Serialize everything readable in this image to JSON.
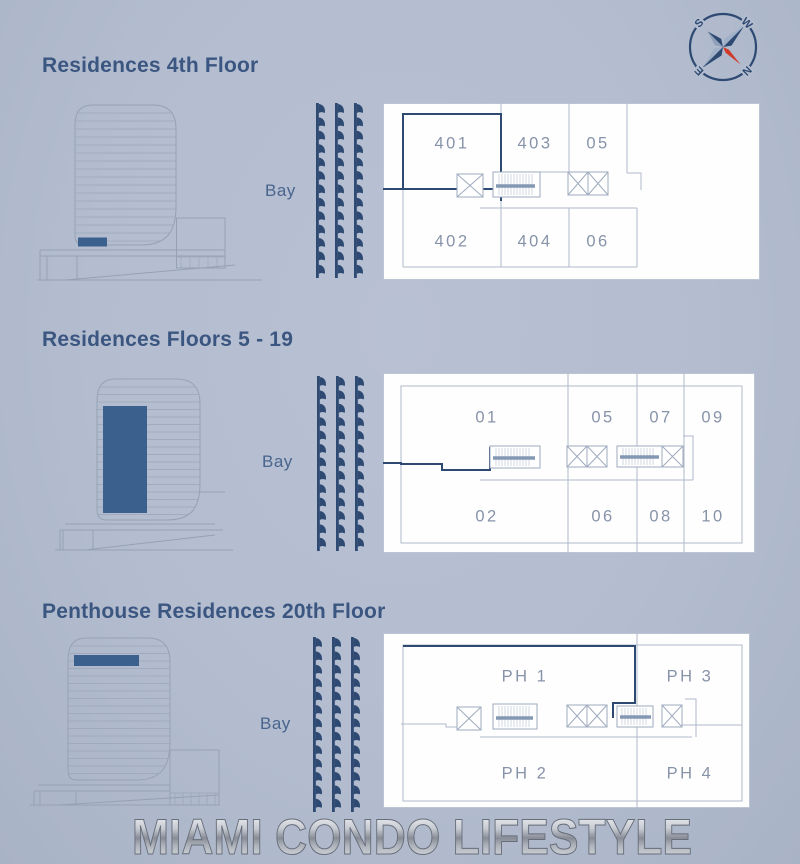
{
  "colors": {
    "background": "#b3bdcf",
    "accent_navy": "#2e4a73",
    "floor_highlight": "#3c608d",
    "title_text": "#3b5680",
    "bay_text": "#49648d",
    "plan_line": "#b0bac9",
    "unit_text": "#8793a9",
    "needle_red": "#d13b2b",
    "plan_background": "#fefefe"
  },
  "compass": {
    "letter_top_left": "S",
    "letter_top_right": "W",
    "letter_bottom_left": "E",
    "letter_bottom_right": "N"
  },
  "sections": [
    {
      "title": "Residences 4th Floor",
      "bay_label": "Bay",
      "units_top": [
        "401",
        "403",
        "05"
      ],
      "units_bottom": [
        "402",
        "404",
        "06"
      ],
      "highlighted_unit": "401"
    },
    {
      "title": "Residences Floors 5 - 19",
      "bay_label": "Bay",
      "units_top": [
        "01",
        "05",
        "07",
        "09"
      ],
      "units_bottom": [
        "02",
        "06",
        "08",
        "10"
      ],
      "highlighted_unit": "01"
    },
    {
      "title": "Penthouse Residences 20th Floor",
      "bay_label": "Bay",
      "units_top": [
        "PH 1",
        "PH 3"
      ],
      "units_bottom": [
        "PH 2",
        "PH 4"
      ],
      "highlighted_unit": "PH 1"
    }
  ],
  "watermark": "MIAMI CONDO LIFESTYLE"
}
